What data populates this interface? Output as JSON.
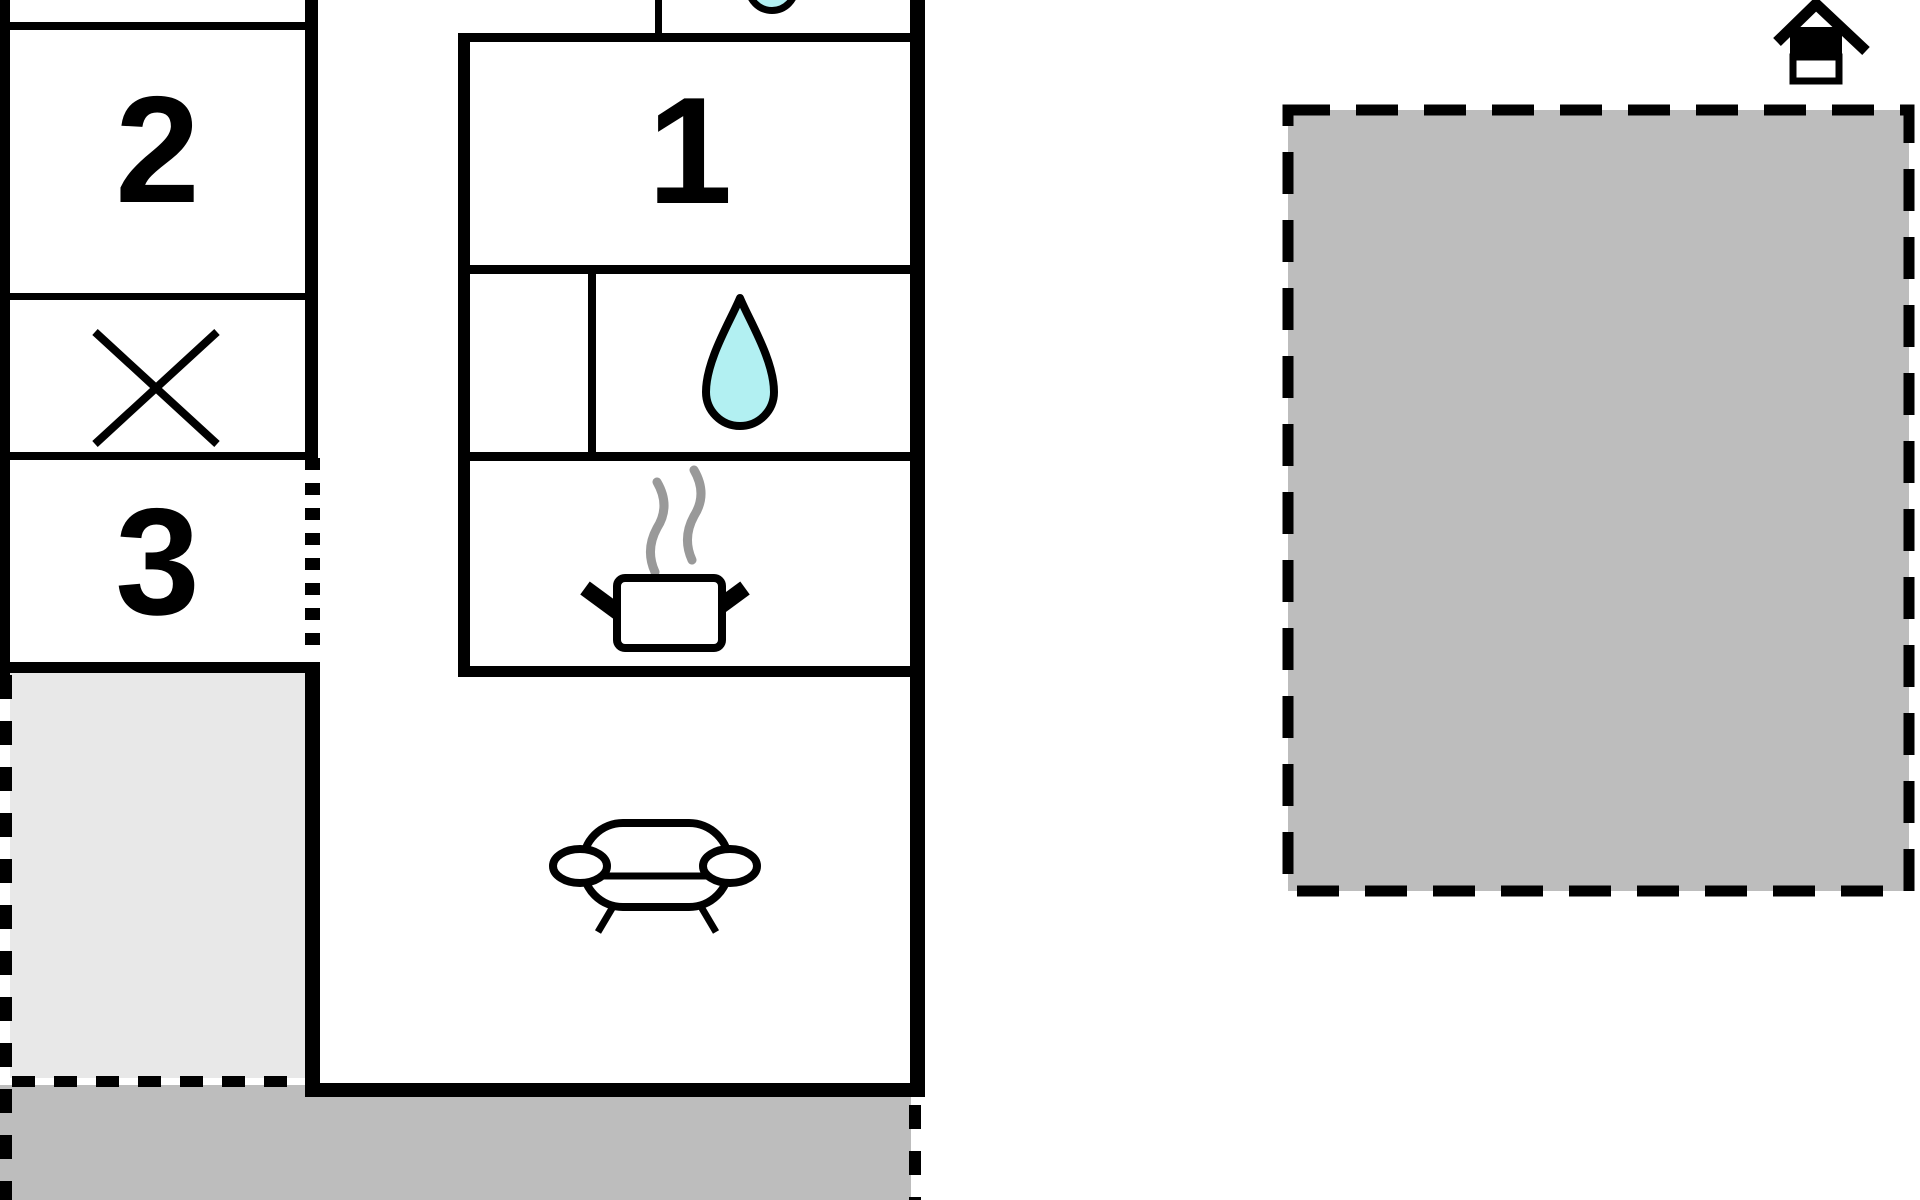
{
  "floor_plan": {
    "type": "floor-plan",
    "room_labels": [
      "1",
      "2",
      "3"
    ],
    "icons": [
      "basin-icon",
      "water-drop-icon",
      "steam-icon",
      "cooking-pot-icon",
      "sofa-icon",
      "x-marker-icon",
      "house-entrance-icon"
    ],
    "colors": {
      "walls": "#000000",
      "water_accent": "#b2f0f2",
      "area_light_gray": "#e8e8e8",
      "area_medium_gray": "#bdbdbd",
      "steam_gray": "#999999"
    }
  }
}
